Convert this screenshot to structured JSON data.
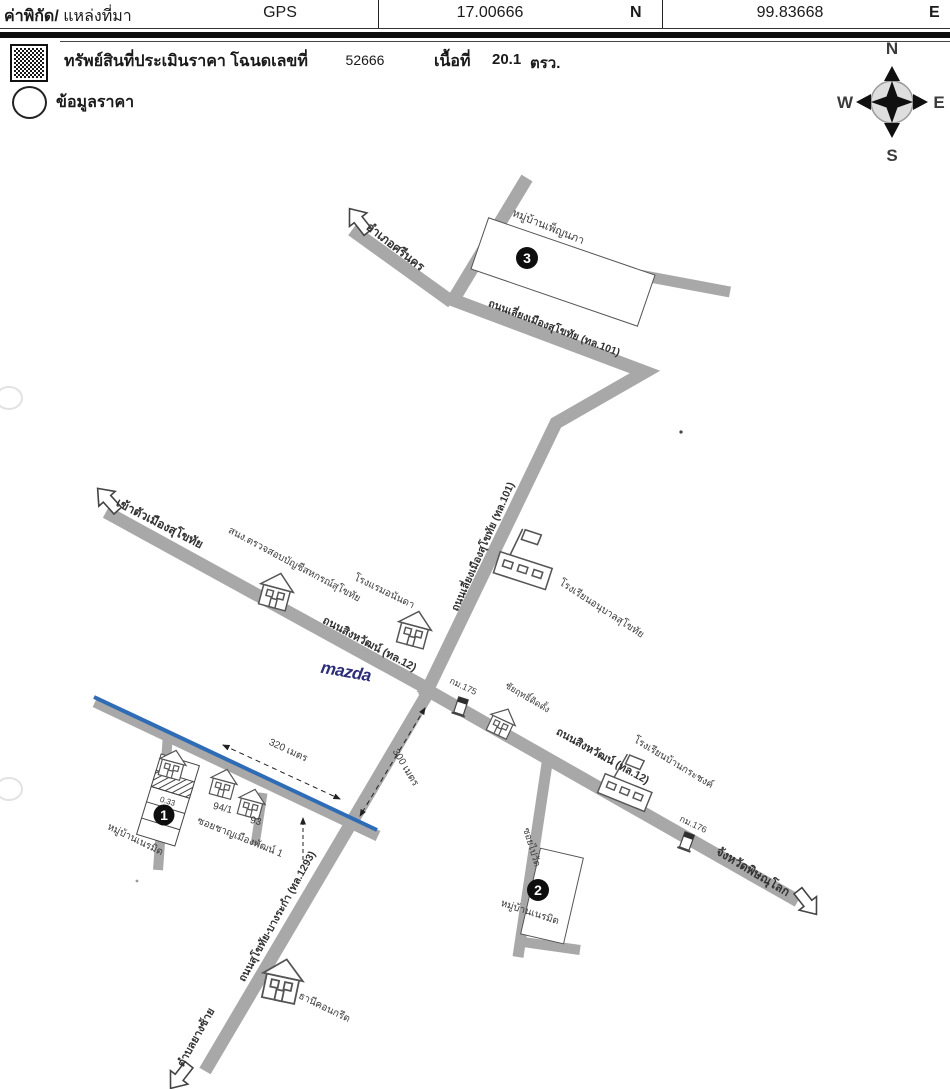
{
  "header": {
    "coord_label": "ค่าพิกัด/",
    "source_label": "แหล่งที่มา",
    "source_value": "GPS",
    "latitude": "17.00666",
    "latitude_dir": "N",
    "longitude": "99.83668",
    "longitude_dir": "E"
  },
  "legend": {
    "property_label": "ทรัพย์สินที่ประเมินราคา โฉนดเลขที่",
    "deed_number": "52666",
    "area_label": "เนื้อที่",
    "area_value": "20.1",
    "area_unit": "ตรว.",
    "price_label": "ข้อมูลราคา"
  },
  "compass": {
    "n": "N",
    "e": "E",
    "s": "S",
    "w": "W"
  },
  "map": {
    "markers": {
      "m1": "1",
      "m2": "2",
      "m3": "3"
    },
    "labels": {
      "amphoe_si_nakhon": "อำเภอศรีนคร",
      "muban_pennapha": "หมู่บ้านเพ็ญนภา",
      "bypass_road_upper": "ถนนเลี่ยงเมืองสุโขทัย (ทล.101)",
      "bypass_road_lower": "ถนนเลี่ยงเมืองสุโขทัย (ทล.101)",
      "into_city": "เข้าตัวเมืองสุโขทัย",
      "audit_office": "สนง.ตรวจสอบบัญชีสหกรณ์สุโขทัย",
      "ananda_hotel": "โรงแรมอนันดา",
      "singhawat_west": "ถนนสิงหวัฒน์ (ทล.12)",
      "anuban_school": "โรงเรียนอนุบาลสุโขทัย",
      "mazda": "mazda",
      "km175": "กม.175",
      "chaiyarit_shop": "ชัยฤทธิ์ติดตั้ง",
      "singhawat_east": "ถนนสิงหวัฒน์ (ทล.12)",
      "krachong_school": "โรงเรียนบ้านกระชงค์",
      "km176": "กม.176",
      "phitsanulok": "จังหวัดพิษณุโลก",
      "dist_320": "320 เมตร",
      "dist_300": "300 เมตร",
      "soi_chan_mueang_phat": "ซอยชาญเมืองพัฒน์ 1",
      "house_94_1": "94/1",
      "house_93": "93",
      "parcel_area": "0.33",
      "muban_left": "หมู่บ้านเนรมิต",
      "soi_pai_wat": "ซอยไปวัด",
      "muban_right": "หมู่บ้านเนรมิต",
      "sukhothai_bangrakam_road": "ถนนสุโขทัย-บางระกำ (ทล.1293)",
      "thani_concrete": "ธานีคอนกรีต",
      "tambon_yang_sai": "ตำบลยางซ้าย"
    }
  }
}
